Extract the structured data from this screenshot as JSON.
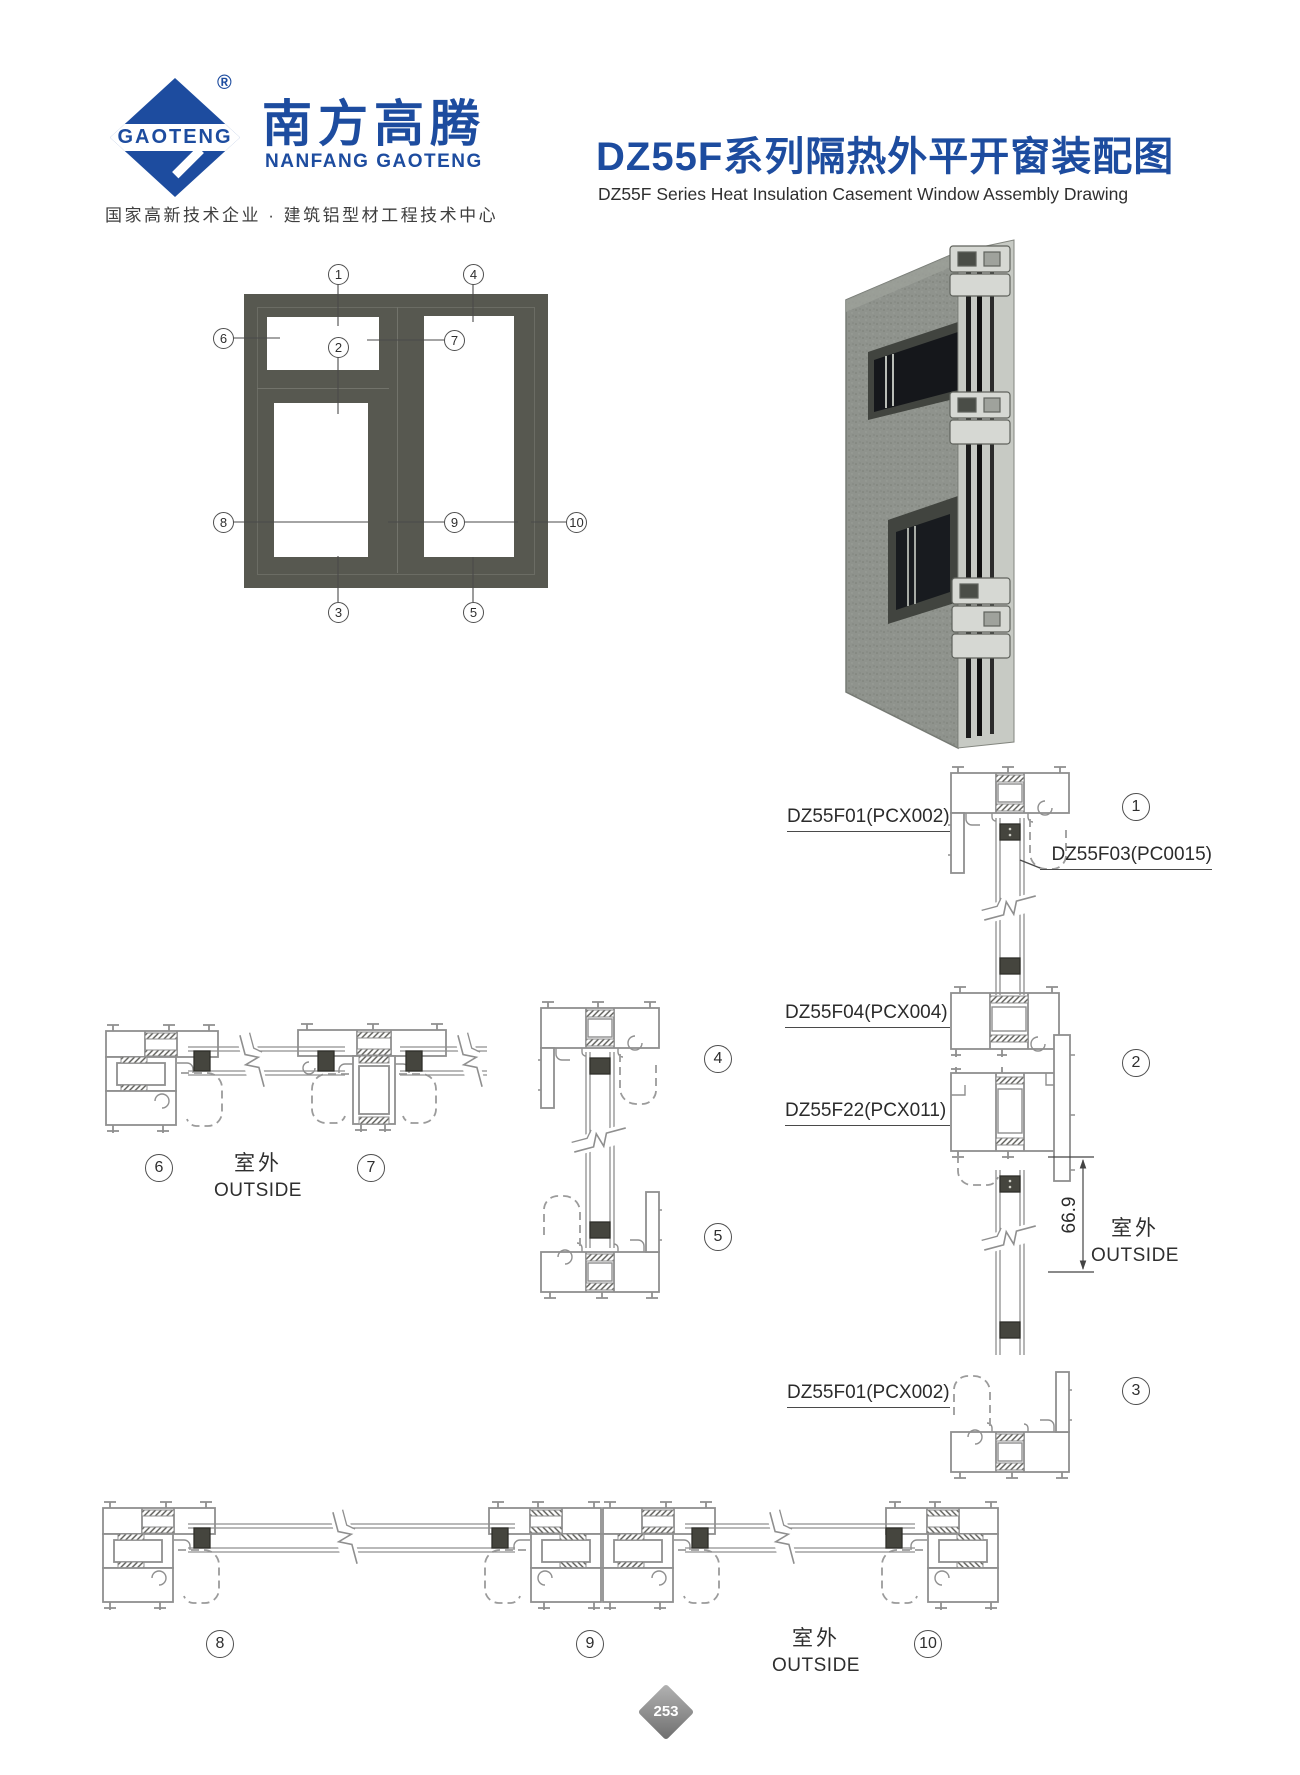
{
  "header": {
    "logo": {
      "mark": "GAOTENG",
      "registered": "®",
      "name_cn": "南方高腾",
      "name_en": "NANFANG GAOTENG",
      "tagline": "国家高新技术企业 · 建筑铝型材工程技术中心"
    },
    "title_cn": "DZ55F系列隔热外平开窗装配图",
    "title_en": "DZ55F Series Heat Insulation Casement Window Assembly Drawing"
  },
  "callouts": {
    "c1": "1",
    "c2": "2",
    "c3": "3",
    "c4": "4",
    "c5": "5",
    "c6": "6",
    "c7": "7",
    "c8": "8",
    "c9": "9",
    "c10": "10"
  },
  "section_labels": {
    "top_frame": "DZ55F01(PCX002)",
    "sash": "DZ55F03(PC0015)",
    "transom": "DZ55F04(PCX004)",
    "transom_sash": "DZ55F22(PCX011)",
    "bottom_frame": "DZ55F01(PCX002)"
  },
  "annotations": {
    "outside_cn": "室外",
    "outside_en": "OUTSIDE",
    "dim_669": "66.9"
  },
  "footer": {
    "page_number": "253"
  },
  "colors": {
    "brand_blue": "#1d4c9f",
    "frame_gray": "#575850",
    "line_gray": "#8f8f8f",
    "text_dark": "#2b2b2b"
  }
}
